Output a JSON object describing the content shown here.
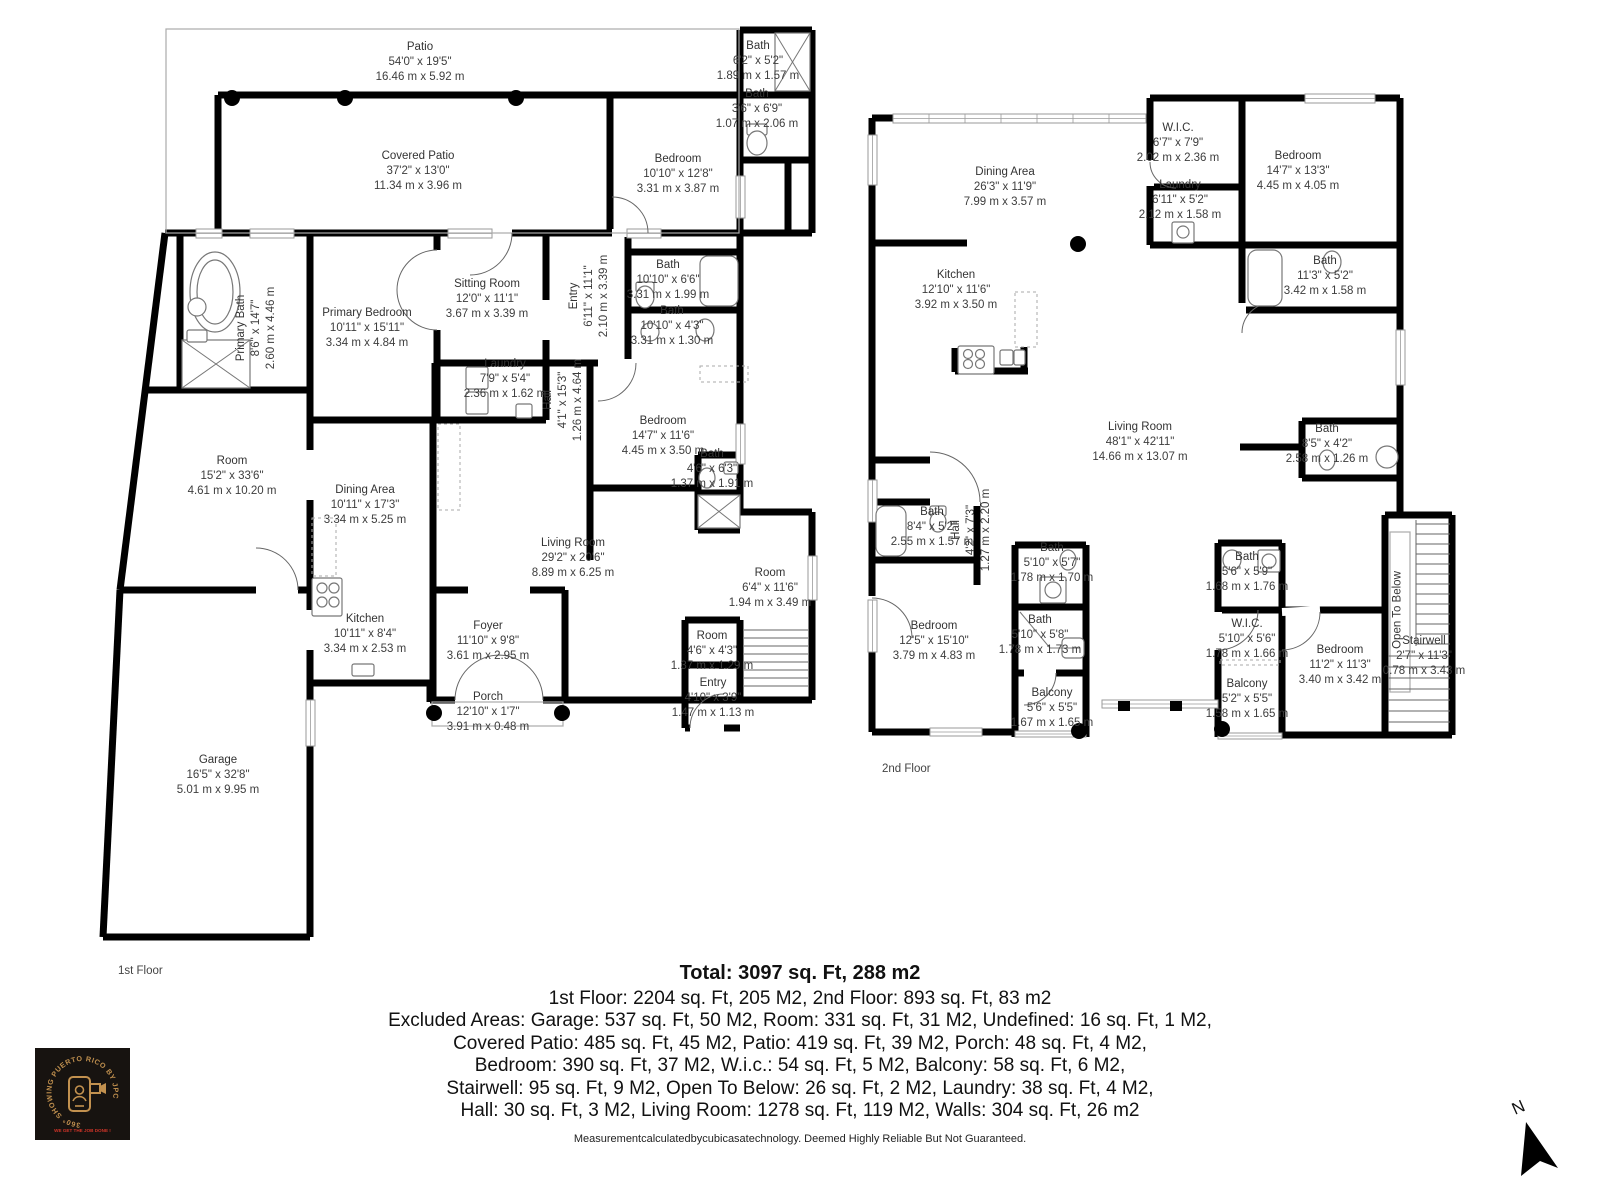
{
  "floor_plan": {
    "floor1": {
      "caption": "1st Floor",
      "rooms": [
        {
          "id": "patio",
          "name": "Patio",
          "imperial": "54'0\" x 19'5\"",
          "metric": "16.46 m x 5.92 m"
        },
        {
          "id": "covered_patio",
          "name": "Covered Patio",
          "imperial": "37'2\" x 13'0\"",
          "metric": "11.34 m x 3.96 m"
        },
        {
          "id": "bath_1a",
          "name": "Bath",
          "imperial": "6'2\" x 5'2\"",
          "metric": "1.89 m x 1.57 m"
        },
        {
          "id": "bath_1b",
          "name": "Bath",
          "imperial": "3'6\" x 6'9\"",
          "metric": "1.07 m x 2.06 m"
        },
        {
          "id": "bedroom_1a",
          "name": "Bedroom",
          "imperial": "10'10\" x 12'8\"",
          "metric": "3.31 m x 3.87 m"
        },
        {
          "id": "primary_bath",
          "name": "Primary Bath",
          "imperial": "8'6\" x 14'7\"",
          "metric": "2.60 m x 4.46 m"
        },
        {
          "id": "primary_bedroom",
          "name": "Primary Bedroom",
          "imperial": "10'11\" x 15'11\"",
          "metric": "3.34 m x 4.84 m"
        },
        {
          "id": "sitting_room",
          "name": "Sitting Room",
          "imperial": "12'0\" x 11'1\"",
          "metric": "3.67 m x 3.39 m"
        },
        {
          "id": "entry_1",
          "name": "Entry",
          "imperial": "6'11\" x 11'1\"",
          "metric": "2.10 m x 3.39 m"
        },
        {
          "id": "bath_1c",
          "name": "Bath",
          "imperial": "10'10\" x 6'6\"",
          "metric": "3.31 m x 1.99 m"
        },
        {
          "id": "bath_1d",
          "name": "Bath",
          "imperial": "10'10\" x 4'3\"",
          "metric": "3.31 m x 1.30 m"
        },
        {
          "id": "laundry_1",
          "name": "Laundry",
          "imperial": "7'9\" x 5'4\"",
          "metric": "2.36 m x 1.62 m"
        },
        {
          "id": "hall_1",
          "name": "Hall",
          "imperial": "4'1\" x 15'3\"",
          "metric": "1.26 m x 4.64 m"
        },
        {
          "id": "bedroom_1b",
          "name": "Bedroom",
          "imperial": "14'7\" x 11'6\"",
          "metric": "4.45 m x 3.50 m"
        },
        {
          "id": "bath_1e",
          "name": "Bath",
          "imperial": "4'6\" x 6'3\"",
          "metric": "1.37 m x 1.91 m"
        },
        {
          "id": "room_1a",
          "name": "Room",
          "imperial": "15'2\" x 33'6\"",
          "metric": "4.61 m x 10.20 m"
        },
        {
          "id": "dining_1",
          "name": "Dining Area",
          "imperial": "10'11\" x 17'3\"",
          "metric": "3.34 m x 5.25 m"
        },
        {
          "id": "living_1",
          "name": "Living Room",
          "imperial": "29'2\" x 20'6\"",
          "metric": "8.89 m x 6.25 m"
        },
        {
          "id": "room_1b",
          "name": "Room",
          "imperial": "6'4\" x 11'6\"",
          "metric": "1.94 m x 3.49 m"
        },
        {
          "id": "kitchen_1",
          "name": "Kitchen",
          "imperial": "10'11\" x 8'4\"",
          "metric": "3.34 m x 2.53 m"
        },
        {
          "id": "foyer_1",
          "name": "Foyer",
          "imperial": "11'10\" x 9'8\"",
          "metric": "3.61 m x 2.95 m"
        },
        {
          "id": "room_1c",
          "name": "Room",
          "imperial": "4'6\" x 4'3\"",
          "metric": "1.37 m x 1.29 m"
        },
        {
          "id": "entry_1b",
          "name": "Entry",
          "imperial": "4'10\" x 3'9\"",
          "metric": "1.47 m x 1.13 m"
        },
        {
          "id": "porch_1",
          "name": "Porch",
          "imperial": "12'10\" x 1'7\"",
          "metric": "3.91 m x 0.48 m"
        },
        {
          "id": "garage_1",
          "name": "Garage",
          "imperial": "16'5\" x 32'8\"",
          "metric": "5.01 m x 9.95 m"
        }
      ]
    },
    "floor2": {
      "caption": "2nd Floor",
      "rooms": [
        {
          "id": "dining_2",
          "name": "Dining Area",
          "imperial": "26'3\" x 11'9\"",
          "metric": "7.99 m x 3.57 m"
        },
        {
          "id": "wic_2a",
          "name": "W.I.C.",
          "imperial": "6'7\" x 7'9\"",
          "metric": "2.02 m x 2.36 m"
        },
        {
          "id": "laundry_2",
          "name": "Laundry",
          "imperial": "6'11\" x 5'2\"",
          "metric": "2.12 m x 1.58 m"
        },
        {
          "id": "bedroom_2a",
          "name": "Bedroom",
          "imperial": "14'7\" x 13'3\"",
          "metric": "4.45 m x 4.05 m"
        },
        {
          "id": "kitchen_2",
          "name": "Kitchen",
          "imperial": "12'10\" x 11'6\"",
          "metric": "3.92 m x 3.50 m"
        },
        {
          "id": "bath_2a",
          "name": "Bath",
          "imperial": "11'3\" x 5'2\"",
          "metric": "3.42 m x 1.58 m"
        },
        {
          "id": "living_2",
          "name": "Living Room",
          "imperial": "48'1\" x 42'11\"",
          "metric": "14.66 m x 13.07 m"
        },
        {
          "id": "bath_2b",
          "name": "Bath",
          "imperial": "8'5\" x 4'2\"",
          "metric": "2.58 m x 1.26 m"
        },
        {
          "id": "bath_2c",
          "name": "Bath",
          "imperial": "8'4\" x 5'2\"",
          "metric": "2.55 m x 1.57 m"
        },
        {
          "id": "hall_2",
          "name": "Hall",
          "imperial": "4'2\" x 7'3\"",
          "metric": "1.27 m x 2.20 m"
        },
        {
          "id": "bath_2d",
          "name": "Bath",
          "imperial": "5'10\" x 5'7\"",
          "metric": "1.78 m x 1.70 m"
        },
        {
          "id": "bath_2e",
          "name": "Bath",
          "imperial": "5'10\" x 5'8\"",
          "metric": "1.78 m x 1.73 m"
        },
        {
          "id": "bedroom_2b",
          "name": "Bedroom",
          "imperial": "12'5\" x 15'10\"",
          "metric": "3.79 m x 4.83 m"
        },
        {
          "id": "balcony_2a",
          "name": "Balcony",
          "imperial": "5'6\" x 5'5\"",
          "metric": "1.67 m x 1.65 m"
        },
        {
          "id": "bath_2f",
          "name": "Bath",
          "imperial": "5'6\" x 5'9\"",
          "metric": "1.68 m x 1.76 m"
        },
        {
          "id": "wic_2b",
          "name": "W.I.C.",
          "imperial": "5'10\" x 5'6\"",
          "metric": "1.78 m x 1.66 m"
        },
        {
          "id": "bedroom_2c",
          "name": "Bedroom",
          "imperial": "11'2\" x 11'3\"",
          "metric": "3.40 m x 3.42 m"
        },
        {
          "id": "balcony_2b",
          "name": "Balcony",
          "imperial": "5'2\" x 5'5\"",
          "metric": "1.58 m x 1.65 m"
        },
        {
          "id": "open_below",
          "name": "Open To Below"
        },
        {
          "id": "stairwell_2",
          "name": "Stairwell",
          "imperial": "2'7\" x 11'3\"",
          "metric": "0.78 m x 3.43 m"
        }
      ]
    }
  },
  "summary": {
    "total": "Total: 3097 sq. Ft, 288 m2",
    "lines": [
      "1st Floor: 2204 sq. Ft, 205 M2, 2nd Floor: 893 sq. Ft, 83 m2",
      "Excluded Areas: Garage: 537 sq. Ft, 50 M2, Room: 331 sq. Ft, 31 M2, Undefined: 16 sq. Ft, 1 M2,",
      "Covered Patio: 485 sq. Ft, 45 M2, Patio: 419 sq. Ft, 39 M2, Porch: 48 sq. Ft, 4 M2,",
      "Bedroom: 390 sq. Ft, 37 M2, W.i.c.: 54 sq. Ft, 5 M2, Balcony: 58 sq. Ft, 6 M2,",
      "Stairwell: 95 sq. Ft, 9 M2, Open To Below: 26 sq. Ft, 2 M2, Laundry: 38 sq. Ft, 4 M2,",
      "Hall: 30 sq. Ft, 3 M2, Living Room: 1278 sq. Ft, 119 M2, Walls: 304 sq. Ft, 26 m2"
    ],
    "disclaimer": "Measurementcalculatedbycubicasatechnology. Deemed Highly Reliable But Not Guaranteed."
  },
  "logo": {
    "circle_text": "360° SHOWING PUERTO RICO BY JPC",
    "tagline": "WE GET THE JOB DONE !"
  },
  "compass": {
    "north_label": "N"
  },
  "colors": {
    "wall": "#000000",
    "logo_gold": "#c2914f",
    "logo_red": "#d03428"
  }
}
